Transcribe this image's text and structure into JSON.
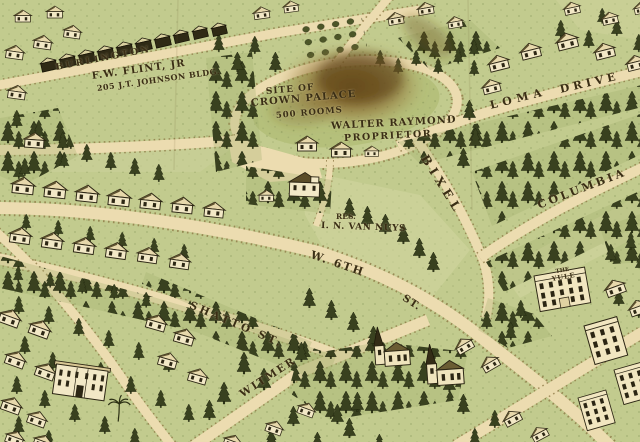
{
  "map": {
    "site_notice": {
      "line1": "SITE OF",
      "line2": "CROWN PALACE",
      "line3": "500 ROOMS"
    },
    "proprietor_notice": {
      "line1": "WALTER RAYMOND",
      "line2": "PROPRIETOR"
    },
    "flint_notice": {
      "line1": "F.W. FLINT, JR",
      "line2": "205 J.T. JOHNSON BLDG."
    },
    "residence_notice": {
      "line1": "RES.",
      "line2": "I. N. VAN NUYS"
    },
    "streets": {
      "burlington": "BURLINGTON",
      "loma": "LOMA",
      "drive": "DRIVE",
      "columbia": "COLUMBIA",
      "bixel": "BIXEL",
      "w6th": "W. 6TH",
      "w6th_st": "ST.",
      "shatto": "SHATTO ST.",
      "witmer": "WITMER"
    },
    "buildings": {
      "yule_line1": "THE",
      "yule_line2": "YULE"
    },
    "colors": {
      "grass": "#c2cb8e",
      "road": "#ecdcb0",
      "ink": "#3a2e15",
      "stain": "#7a5624"
    }
  }
}
